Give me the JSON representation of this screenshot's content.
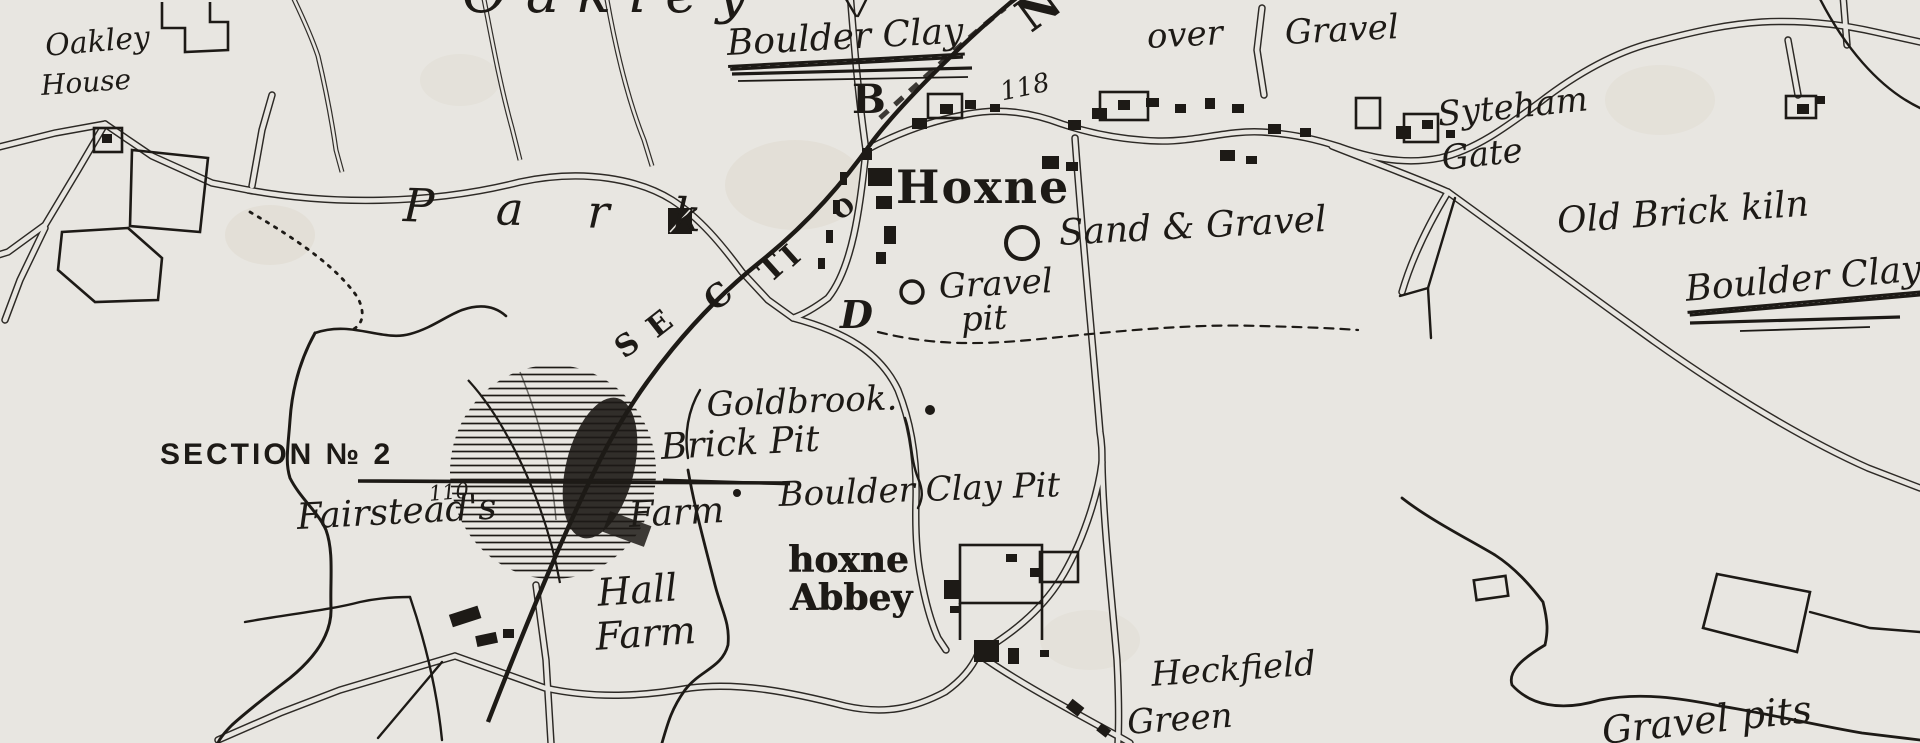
{
  "map": {
    "description": "Antique engraved survey map of Hoxne area with geological annotations",
    "colors": {
      "paper": "#e8e6e1",
      "ink": "#1d1a16"
    },
    "labels": [
      {
        "name": "label-oakley-parish",
        "text": "Oakley",
        "x": 462,
        "y": -34,
        "size": 56,
        "style": "script",
        "rot": 0,
        "ls": 18
      },
      {
        "name": "label-oakley-house-line1",
        "text": "Oakley",
        "x": 44,
        "y": 32,
        "size": 30,
        "style": "script",
        "rot": -5
      },
      {
        "name": "label-oakley-house-line2",
        "text": "House",
        "x": 40,
        "y": 72,
        "size": 28,
        "style": "script",
        "rot": -4
      },
      {
        "name": "label-boulder-clay-top",
        "text": "Boulder Clay",
        "x": 726,
        "y": 26,
        "size": 36,
        "style": "script",
        "rot": -3,
        "underline": 2
      },
      {
        "name": "label-point-b",
        "text": "B",
        "x": 852,
        "y": 80,
        "size": 40,
        "style": "bold-serif",
        "rot": 0
      },
      {
        "name": "label-over",
        "text": "over",
        "x": 1146,
        "y": 20,
        "size": 34,
        "style": "script",
        "rot": -3
      },
      {
        "name": "label-gravel-top",
        "text": "Gravel",
        "x": 1284,
        "y": 16,
        "size": 34,
        "style": "script",
        "rot": -3
      },
      {
        "name": "label-height-118",
        "text": "118",
        "x": 998,
        "y": 80,
        "size": 26,
        "style": "script",
        "rot": -12
      },
      {
        "name": "label-syteham",
        "text": "Syteham",
        "x": 1436,
        "y": 98,
        "size": 34,
        "style": "script",
        "rot": -6
      },
      {
        "name": "label-gate",
        "text": "Gate",
        "x": 1440,
        "y": 142,
        "size": 34,
        "style": "script",
        "rot": -6
      },
      {
        "name": "label-hoxne",
        "text": "Hoxne",
        "x": 896,
        "y": 164,
        "size": 46,
        "style": "bold-serif",
        "rot": 0,
        "ls": 2
      },
      {
        "name": "label-sand-and-gravel",
        "text": "Sand & Gravel",
        "x": 1058,
        "y": 216,
        "size": 36,
        "style": "script",
        "rot": -3
      },
      {
        "name": "label-gravel-pit-line1",
        "text": "Gravel",
        "x": 938,
        "y": 270,
        "size": 34,
        "style": "script",
        "rot": -3
      },
      {
        "name": "label-gravel-pit-line2",
        "text": "pit",
        "x": 960,
        "y": 303,
        "size": 34,
        "style": "script",
        "rot": -3
      },
      {
        "name": "label-old-brick-kiln",
        "text": "Old Brick kiln",
        "x": 1556,
        "y": 204,
        "size": 36,
        "style": "script",
        "rot": -4
      },
      {
        "name": "label-boulder-clay-right",
        "text": "Boulder Clay",
        "x": 1684,
        "y": 272,
        "size": 36,
        "style": "script",
        "rot": -5,
        "underline": 2
      },
      {
        "name": "label-park",
        "text": "Park",
        "x": 404,
        "y": 182,
        "size": 46,
        "style": "script",
        "rot": 2,
        "ls": 64
      },
      {
        "name": "label-section-letter-s",
        "text": "S",
        "x": 610,
        "y": 340,
        "size": 30,
        "style": "bold-serif",
        "rot": -36
      },
      {
        "name": "label-section-letter-e",
        "text": "E",
        "x": 642,
        "y": 320,
        "size": 30,
        "style": "bold-serif",
        "rot": -38
      },
      {
        "name": "label-section-letter-c",
        "text": "C",
        "x": 698,
        "y": 292,
        "size": 32,
        "style": "bold-serif",
        "rot": -40
      },
      {
        "name": "label-section-letter-t",
        "text": "T",
        "x": 752,
        "y": 264,
        "size": 32,
        "style": "bold-serif",
        "rot": -42
      },
      {
        "name": "label-section-letter-i",
        "text": "I",
        "x": 776,
        "y": 250,
        "size": 30,
        "style": "bold-serif",
        "rot": -42
      },
      {
        "name": "label-section-letter-o",
        "text": "O",
        "x": 828,
        "y": 206,
        "size": 24,
        "style": "bold-serif",
        "rot": -40
      },
      {
        "name": "label-section-letter-n",
        "text": "N",
        "x": 1008,
        "y": 2,
        "size": 46,
        "style": "bold-serif",
        "rot": -36
      },
      {
        "name": "label-point-d",
        "text": "D",
        "x": 840,
        "y": 296,
        "size": 38,
        "style": "bold-serif-italic",
        "rot": 0
      },
      {
        "name": "label-goldbrook",
        "text": "Goldbrook.",
        "x": 706,
        "y": 388,
        "size": 34,
        "style": "script",
        "rot": -2
      },
      {
        "name": "label-section-no2",
        "text": "SECTION № 2",
        "x": 160,
        "y": 440,
        "size": 30,
        "style": "sans",
        "rot": 0,
        "ls": 3
      },
      {
        "name": "label-height-110",
        "text": "110.",
        "x": 428,
        "y": 484,
        "size": 21,
        "style": "script",
        "rot": -5
      },
      {
        "name": "label-fairsteads",
        "text": "Fairstead's",
        "x": 296,
        "y": 500,
        "size": 36,
        "style": "script",
        "rot": -3
      },
      {
        "name": "label-fairsteads-farm",
        "text": "Farm",
        "x": 628,
        "y": 498,
        "size": 36,
        "style": "script",
        "rot": -3
      },
      {
        "name": "label-brick-pit",
        "text": "Brick Pit",
        "x": 660,
        "y": 430,
        "size": 36,
        "style": "script",
        "rot": -3
      },
      {
        "name": "label-boulder-clay-pit",
        "text": "Boulder Clay Pit",
        "x": 778,
        "y": 478,
        "size": 34,
        "style": "script",
        "rot": -2
      },
      {
        "name": "label-hoxne-abbey-line1",
        "text": "hoxne",
        "x": 788,
        "y": 542,
        "size": 36,
        "style": "gothic",
        "rot": 0
      },
      {
        "name": "label-hoxne-abbey-line2",
        "text": "Abbey",
        "x": 790,
        "y": 580,
        "size": 36,
        "style": "gothic",
        "rot": 0
      },
      {
        "name": "label-hall-farm-line1",
        "text": "Hall",
        "x": 596,
        "y": 574,
        "size": 38,
        "style": "script",
        "rot": -4
      },
      {
        "name": "label-hall-farm-line2",
        "text": "Farm",
        "x": 594,
        "y": 618,
        "size": 38,
        "style": "script",
        "rot": -4
      },
      {
        "name": "label-heckfield",
        "text": "Heckfield",
        "x": 1150,
        "y": 658,
        "size": 34,
        "style": "script",
        "rot": -4
      },
      {
        "name": "label-heckfield-green",
        "text": "Green",
        "x": 1126,
        "y": 706,
        "size": 34,
        "style": "script",
        "rot": -4
      },
      {
        "name": "label-gravel-pits",
        "text": "Gravel pits",
        "x": 1600,
        "y": 712,
        "size": 38,
        "style": "script",
        "rot": -6
      }
    ],
    "markers": {
      "pit_circles": [
        {
          "name": "sand-gravel-pit-circle",
          "x": 1022,
          "y": 243,
          "r": 16
        },
        {
          "name": "gravel-pit-circle",
          "x": 912,
          "y": 292,
          "r": 11
        }
      ],
      "dots": [
        {
          "name": "goldbrook-dot",
          "x": 930,
          "y": 410,
          "r": 5
        },
        {
          "name": "section-rule-dot",
          "x": 737,
          "y": 493,
          "r": 4
        }
      ]
    }
  }
}
